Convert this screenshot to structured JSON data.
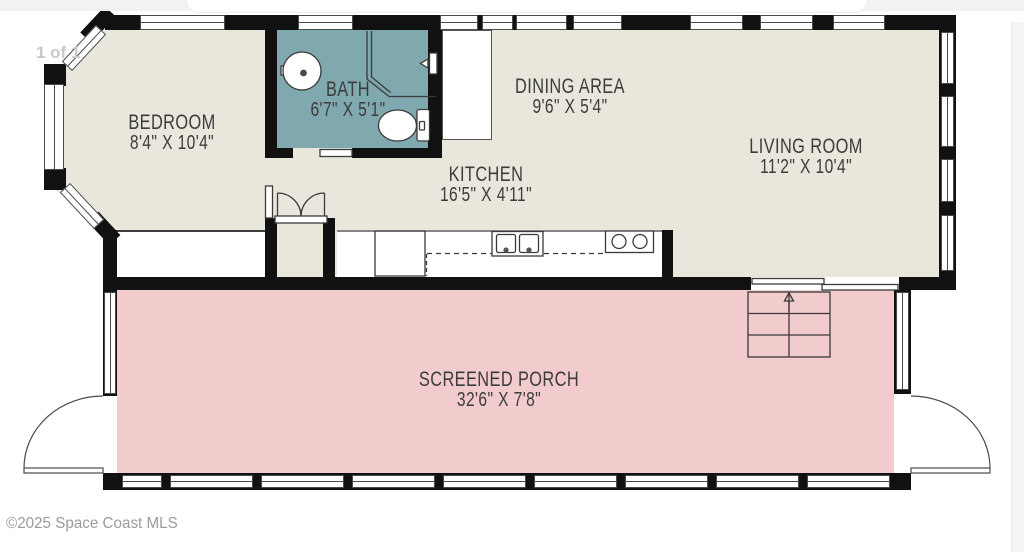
{
  "page": {
    "counter": "1 of 1",
    "copyright": "©2025 Space Coast MLS"
  },
  "colors": {
    "floor": "#e9e7dc",
    "bath": "#7fa9ae",
    "porch": "#f2cbcd",
    "wall": "#111111",
    "label": "#3c3c3c"
  },
  "rooms": {
    "bedroom": {
      "name": "BEDROOM",
      "dims": "8'4\" X 10'4\""
    },
    "bath": {
      "name": "BATH",
      "dims": "6'7\" X 5'1\""
    },
    "dining": {
      "name": "DINING AREA",
      "dims": "9'6\" X 5'4\""
    },
    "kitchen": {
      "name": "KITCHEN",
      "dims": "16'5\" X 4'11\""
    },
    "living": {
      "name": "LIVING ROOM",
      "dims": "11'2\" X 10'4\""
    },
    "porch": {
      "name": "SCREENED PORCH",
      "dims": "32'6\" X 7'8\""
    }
  }
}
